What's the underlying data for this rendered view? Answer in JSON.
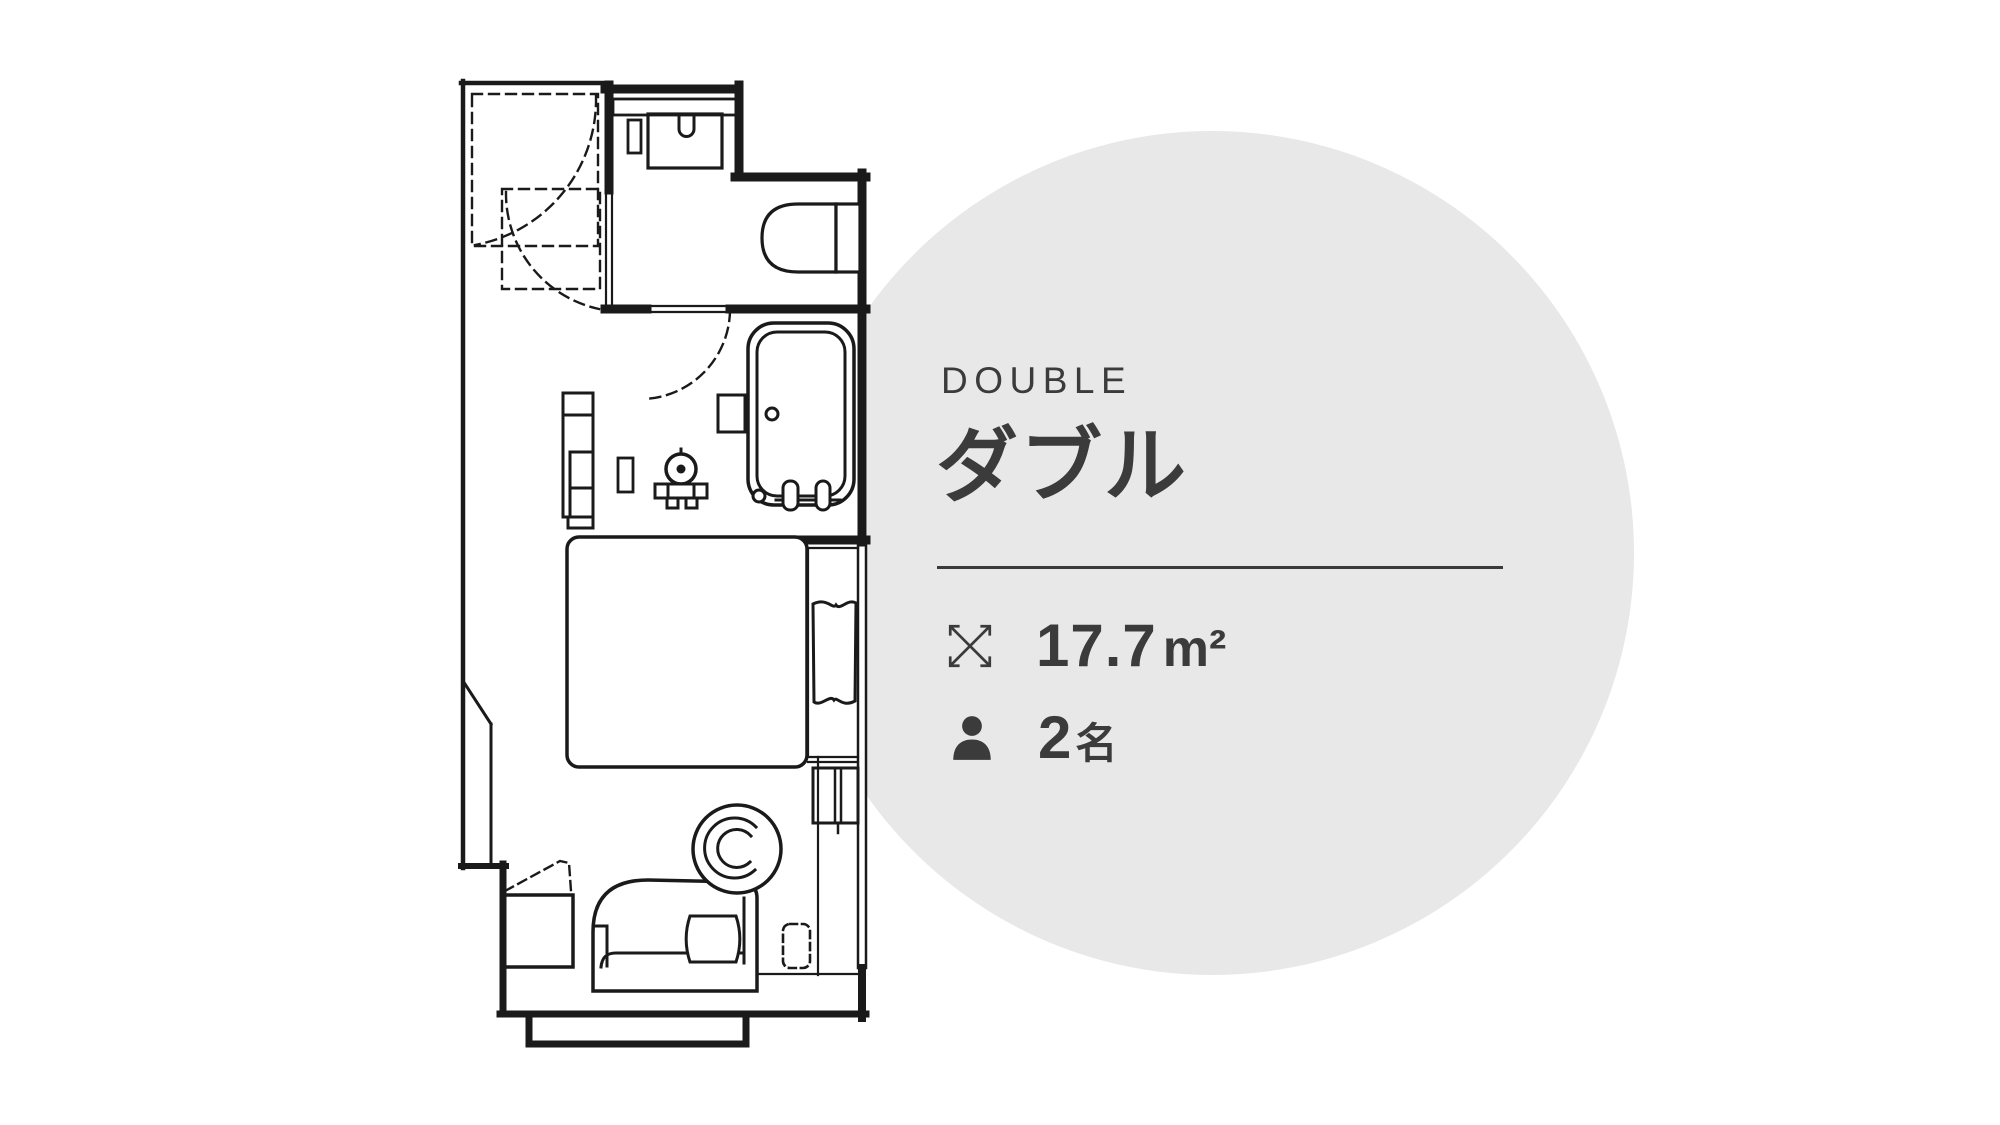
{
  "room": {
    "name_en": "DOUBLE",
    "name_ja": "ダブル",
    "area": {
      "icon": "expand-arrows-icon",
      "value": "17.7",
      "unit": "m²"
    },
    "capacity": {
      "icon": "person-icon",
      "value": "2",
      "unit": "名"
    }
  },
  "floor_plan": {
    "name": "double-room-floor-plan",
    "rooms": [
      "closet",
      "toilet-room",
      "bathroom",
      "bedroom",
      "entry"
    ],
    "fixtures": [
      "sink-counter",
      "toilet",
      "bathtub",
      "washbasin",
      "window-curtain"
    ],
    "furniture": [
      "double-bed",
      "sofa",
      "cushion",
      "round-chair",
      "side-table",
      "ottoman",
      "shelf-unit",
      "ac-unit"
    ]
  },
  "colors": {
    "text": "#3b3b3b",
    "plan_line": "#1a1a1a",
    "circle_bg": "#e8e8e8",
    "background": "#ffffff"
  }
}
